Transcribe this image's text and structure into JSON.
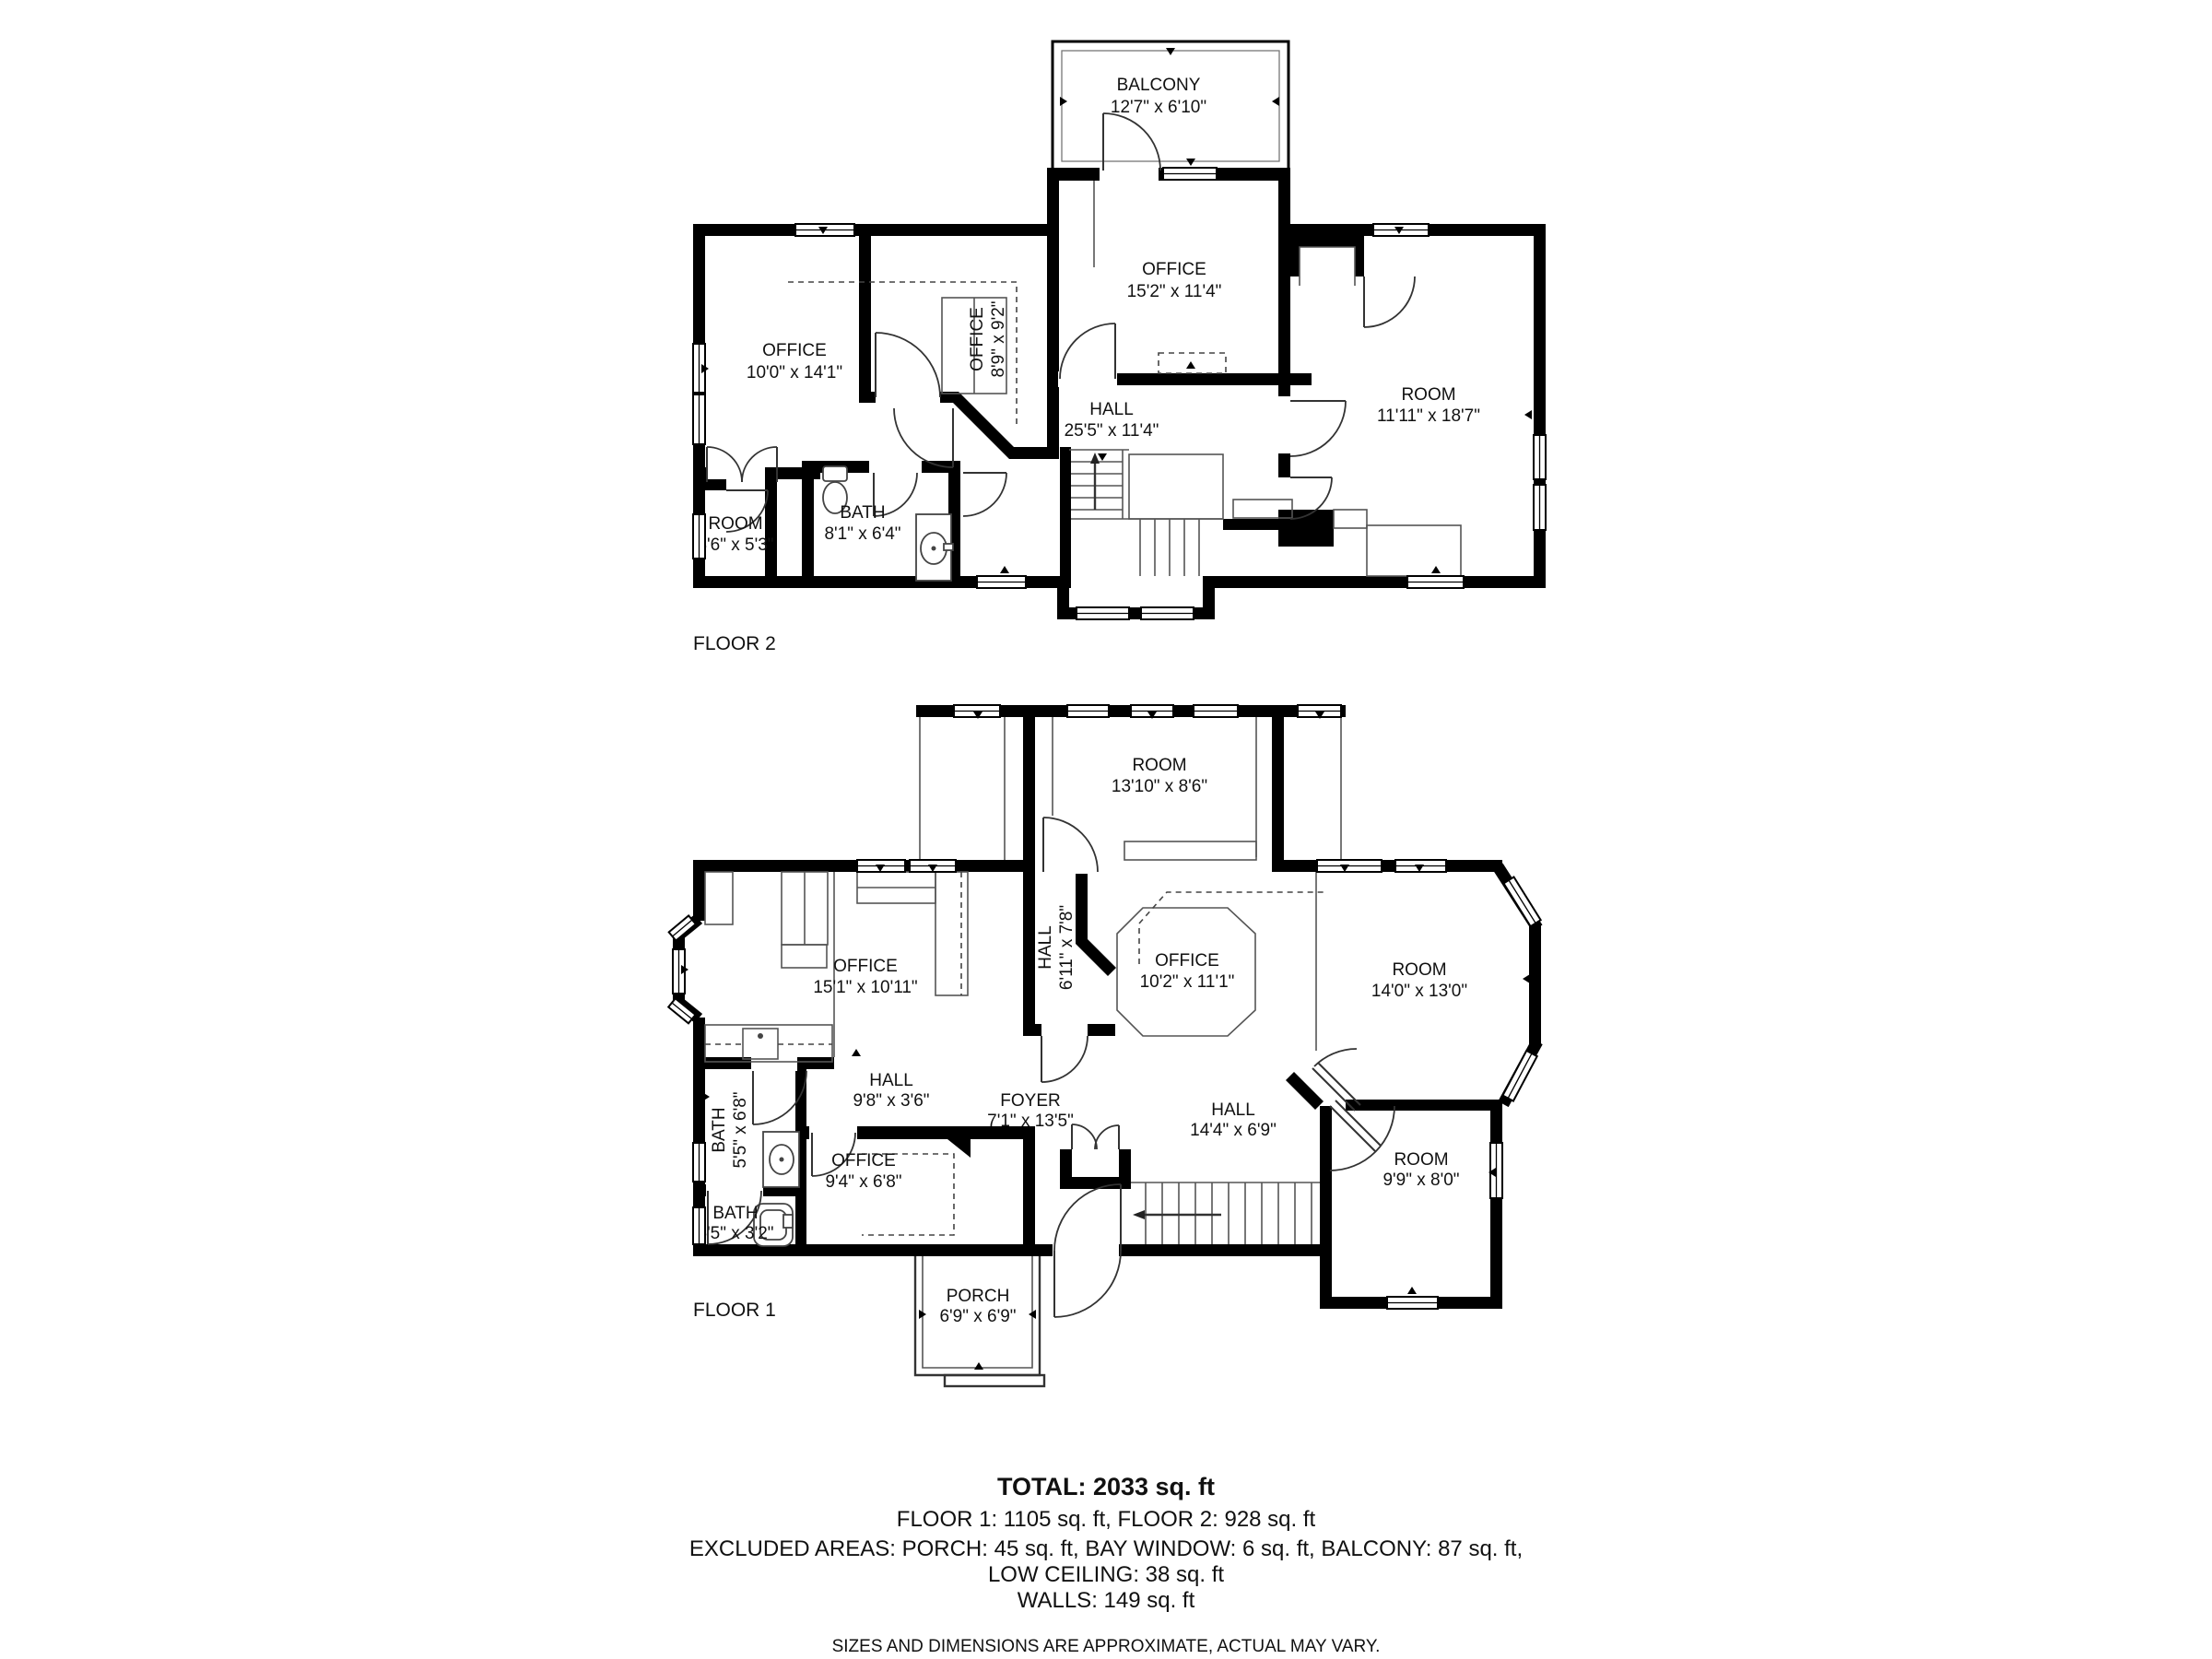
{
  "floor2": {
    "caption": "FLOOR 2",
    "rooms": {
      "balcony": {
        "name": "BALCONY",
        "dims": "12'7\" x 6'10\""
      },
      "office_center": {
        "name": "OFFICE",
        "dims": "15'2\" x 11'4\""
      },
      "office_left": {
        "name": "OFFICE",
        "dims": "10'0\" x 14'1\""
      },
      "office_small": {
        "name": "OFFICE",
        "dims": "8'9\" x 9'2\""
      },
      "hall": {
        "name": "HALL",
        "dims": "25'5\" x 11'4\""
      },
      "room_right": {
        "name": "ROOM",
        "dims": "11'11\" x 18'7\""
      },
      "room_small": {
        "name": "ROOM",
        "dims": "3'6\" x 5'3\""
      },
      "bath": {
        "name": "BATH",
        "dims": "8'1\" x 6'4\""
      }
    }
  },
  "floor1": {
    "caption": "FLOOR 1",
    "rooms": {
      "room_top": {
        "name": "ROOM",
        "dims": "13'10\" x 8'6\""
      },
      "office_kitchen": {
        "name": "OFFICE",
        "dims": "15'1\" x 10'11\""
      },
      "hall_small": {
        "name": "HALL",
        "dims": "6'11\" x 7'8\""
      },
      "office_center": {
        "name": "OFFICE",
        "dims": "10'2\" x 11'1\""
      },
      "room_right": {
        "name": "ROOM",
        "dims": "14'0\" x 13'0\""
      },
      "hall_west": {
        "name": "HALL",
        "dims": "9'8\" x 3'6\""
      },
      "foyer": {
        "name": "FOYER",
        "dims": "7'1\" x 13'5\""
      },
      "hall_east": {
        "name": "HALL",
        "dims": "14'4\" x 6'9\""
      },
      "bath_upper": {
        "name": "BATH",
        "dims": "5'5\" x 6'8\""
      },
      "office_small": {
        "name": "OFFICE",
        "dims": "9'4\" x 6'8\""
      },
      "bath_lower": {
        "name": "BATH",
        "dims": "5'5\" x 3'2\""
      },
      "room_small": {
        "name": "ROOM",
        "dims": "9'9\" x 8'0\""
      },
      "porch": {
        "name": "PORCH",
        "dims": "6'9\" x 6'9\""
      }
    }
  },
  "summary": {
    "total": "TOTAL: 2033 sq. ft",
    "floors": "FLOOR 1: 1105 sq. ft, FLOOR 2: 928 sq. ft",
    "excluded": "EXCLUDED AREAS: PORCH: 45 sq. ft, BAY WINDOW: 6 sq. ft, BALCONY: 87 sq. ft,",
    "low_ceiling": "LOW CEILING: 38 sq. ft",
    "walls": "WALLS: 149 sq. ft",
    "disclaimer": "SIZES AND DIMENSIONS ARE APPROXIMATE, ACTUAL MAY VARY."
  }
}
